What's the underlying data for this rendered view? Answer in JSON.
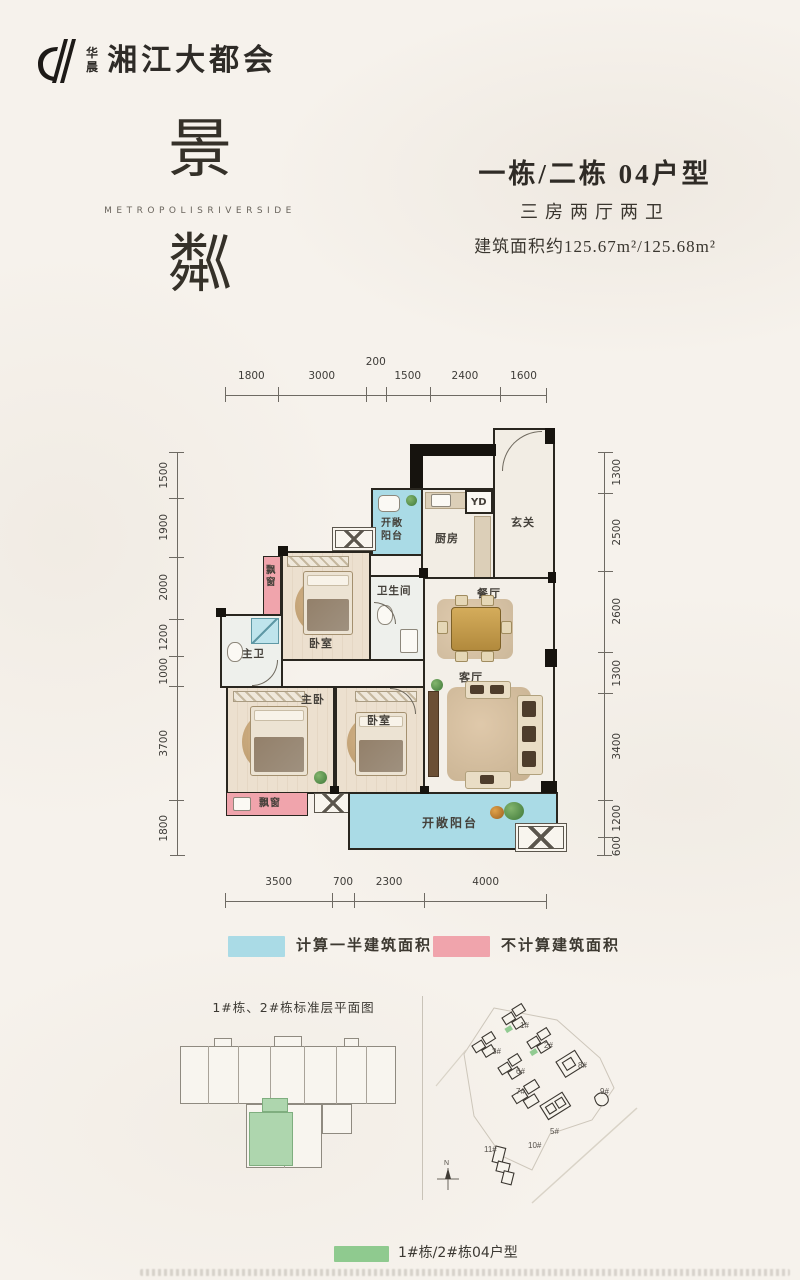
{
  "brand": {
    "name_small": "华晨",
    "name_large": "湘江大都会"
  },
  "hero": {
    "title_top": "景",
    "title_en": "METROPOLISRIVERSIDE",
    "title_bottom": "粼",
    "unit_title": "一栋/二栋 04户型",
    "unit_layout": "三房两厅两卫",
    "unit_area": "建筑面积约125.67m²/125.68m²"
  },
  "floorplan": {
    "dims": {
      "top": [
        "1800",
        "3000",
        "200",
        "1500",
        "2400",
        "1600"
      ],
      "bottom": [
        "3500",
        "700",
        "2300",
        "4000"
      ],
      "left": [
        "1500",
        "1900",
        "2000",
        "1200",
        "1000",
        "3700",
        "1800"
      ],
      "right": [
        "1300",
        "2500",
        "2600",
        "1300",
        "3400",
        "1200",
        "600"
      ]
    },
    "rooms": {
      "balcony_top": "开敞阳台",
      "yd": "YD",
      "kitchen": "厨房",
      "foyer": "玄关",
      "bay_window_top": "飘窗",
      "bedroom_top": "卧室",
      "bathroom": "卫生间",
      "dining": "餐厅",
      "master_bath": "主卫",
      "master_bedroom": "主卧",
      "bedroom_mid": "卧室",
      "living": "客厅",
      "bay_window_bottom": "飘窗",
      "balcony_bottom": "开敞阳台"
    }
  },
  "legend": {
    "half_area": {
      "label": "计算一半建筑面积",
      "color": "#aadbe6"
    },
    "excluded": {
      "label": "不计算建筑面积",
      "color": "#f0a4ac"
    },
    "unit": {
      "label": "1#栋/2#栋04户型",
      "color": "#8fca8f"
    }
  },
  "site": {
    "plate_title": "1#栋、2#栋标准层平面图",
    "buildings": [
      "1#",
      "2#",
      "3#",
      "5#",
      "6#",
      "7#",
      "8#",
      "9#",
      "10#",
      "11#"
    ],
    "compass": "N"
  }
}
